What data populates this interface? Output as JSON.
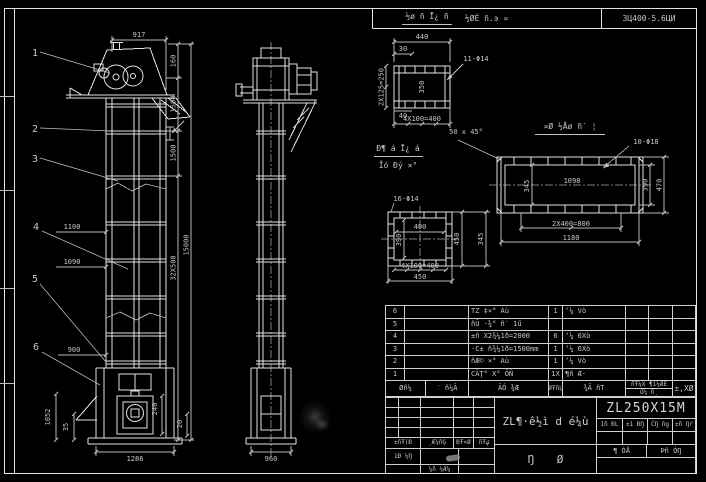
{
  "colors": {
    "background": "#000000",
    "line": "#e2e2e2",
    "text": "#c8c8c8"
  },
  "header": {
    "cell1": "½ØÉ ñ.э ¤",
    "cell2": "3Ц400-5.6ЦИ"
  },
  "front_view": {
    "balloons": [
      "1",
      "2",
      "3",
      "4",
      "5",
      "6"
    ],
    "dim_top": "917",
    "dims_right": [
      "160",
      "1500",
      "1500",
      "32X500"
    ],
    "dim_total": "15000",
    "dims_left": [
      "1100",
      "1090",
      "900"
    ],
    "dims_boot": [
      "1052",
      "35",
      "240",
      "20"
    ],
    "dim_bottom": "1286"
  },
  "side_view": {
    "dim_bottom": "960"
  },
  "section_top": {
    "title": "½ø ñ Ī¿ ñ",
    "dim_width": "440",
    "dim_offset": "30",
    "dim_inner": "350",
    "dim_left": "2X125=250",
    "dim_small": "40",
    "dim_bottom": "4X100=400",
    "holes": "11-Φ14"
  },
  "chamfer_note": "50 x 45°",
  "section_main": {
    "title": "¤Ø ½Åø ñ′ ¦",
    "holes": "10-Φ18",
    "dim_inner": "1098",
    "dim_inner_v": "345",
    "dim_right_1": "390",
    "dim_right_2": "470",
    "dim_bottom_1": "2X400=800",
    "dim_bottom_2": "1180"
  },
  "section_square": {
    "holes": "16-Φ14",
    "dim_inner_h": "400",
    "dim_inner_v": "390",
    "dim_bottom_1": "4X100=400",
    "dim_bottom_2": "450",
    "dim_right_1": "450",
    "dim_right_2": "345"
  },
  "view_label": {
    "line1": "Đ¶ á Ī¿ á",
    "line2": "Ĩó Đý ×°"
  },
  "bom": {
    "header": {
      "no": "Øñ¼",
      "code": "′ ñ¼Ã",
      "name": "ÃÓ ¾Æ",
      "qty": "ØŦñĻ",
      "material": "¾Ã ñT",
      "weight_top": "ñŦ¼X ¶1¼ÆE",
      "weight_sub": "Õ¼ ñ¸",
      "note": "±,XØ"
    },
    "rows": [
      {
        "no": "6",
        "code": "",
        "name": "TZ ‡×° Aù",
        "qty": "1",
        "material": "ʻ¼ Vò",
        "w1": "",
        "w2": ""
      },
      {
        "no": "5",
        "code": "",
        "name": "ñŪ ·¾° ñ′ 1ű",
        "qty": "",
        "material": "",
        "w1": "",
        "w2": ""
      },
      {
        "no": "4",
        "code": "",
        "name": "±ñ X2¾¼1ð=2000",
        "qty": "6",
        "material": "ʻ¼ 6Xò",
        "w1": "",
        "w2": ""
      },
      {
        "no": "3",
        "code": "",
        "name": "·C± ñ¾¼1ð=1500mm",
        "qty": "1",
        "material": "ʻ¼ 6Xò",
        "w1": "",
        "w2": ""
      },
      {
        "no": "2",
        "code": "",
        "name": "ñÆ© ×° Aù",
        "qty": "1",
        "material": "ʻ¼ Vò",
        "w1": "",
        "w2": ""
      },
      {
        "no": "1",
        "code": "",
        "name": "CÄŢ° X° ÕŇ",
        "qty": "1X",
        "material": "¶ñ Æ·",
        "w1": "",
        "w2": ""
      }
    ]
  },
  "titleblock": {
    "rev_labels": [
      "±ñŦ(Đ",
      "¸Æ¼ñĢ",
      "ĐŦ×Ø",
      "ñŦؼ"
    ],
    "design_label": "1Đ ¼Ŋ",
    "check_label": "¼ñ ¼Æ¼",
    "title": "ZL¶·ê½ì d é¼ù",
    "subtitle": "Ŋ Ø",
    "model": "ZL250X15M",
    "stage_labels": [
      "1ñ ĐL",
      "±1 ĐŊ",
      "ĆŊ ñg",
      "±ñ Ŋŕ"
    ],
    "sheet_total": "¶ ÓÅ",
    "sheet_no": "Þñ ÓŊ"
  }
}
